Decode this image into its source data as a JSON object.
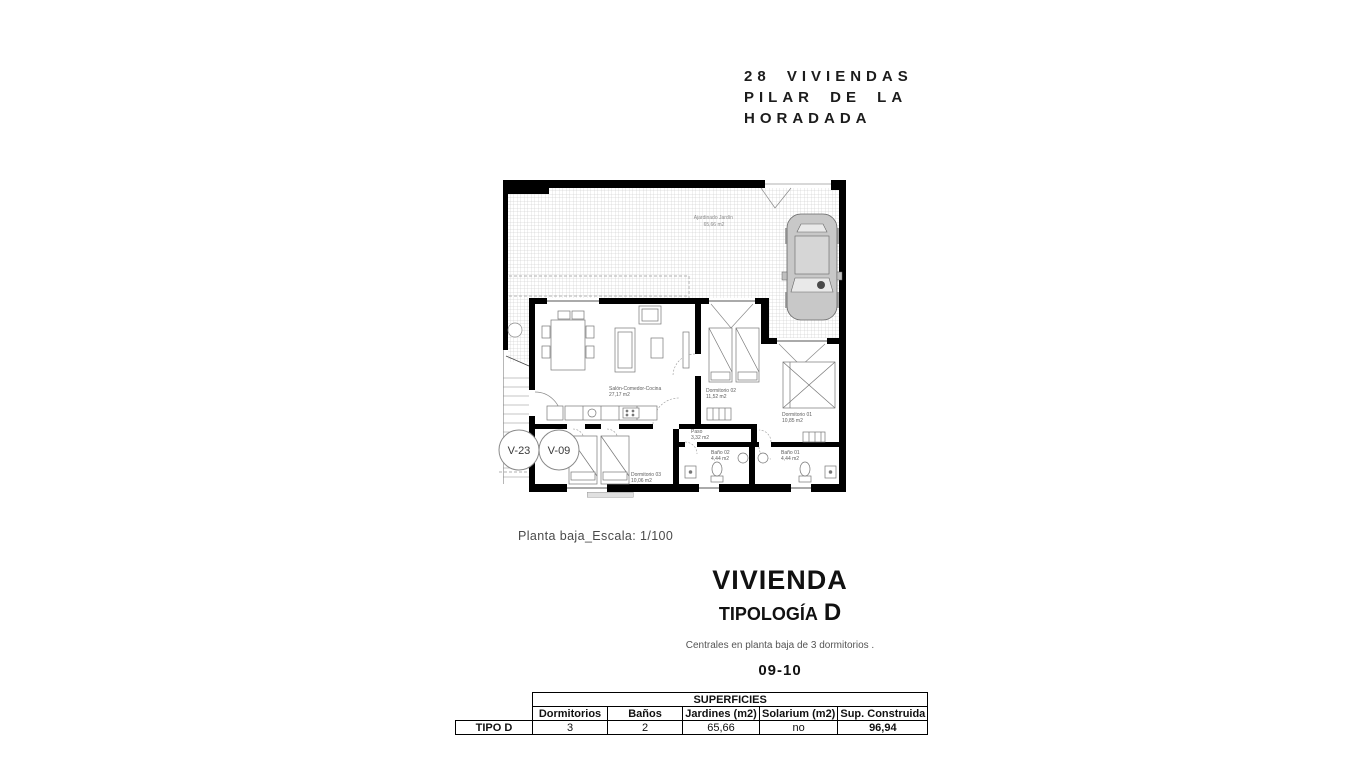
{
  "header": {
    "lines": [
      "28 VIVIENDAS",
      "PILAR DE LA",
      "HORADADA"
    ]
  },
  "plan": {
    "scale_note": "Planta baja_Escala: 1/100",
    "garden": {
      "name": "Ajardinado Jardín",
      "area": "65,66 m2"
    },
    "rooms": [
      {
        "name": "Salón-Comedor-Cocina",
        "area": "27,17 m2"
      },
      {
        "name": "Dormitorio 02",
        "area": "11,52 m2"
      },
      {
        "name": "Dormitorio 01",
        "area": "10,85 m2"
      },
      {
        "name": "Paso",
        "area": "3,32 m2"
      },
      {
        "name": "Baño 02",
        "area": "4,44 m2"
      },
      {
        "name": "Baño 01",
        "area": "4,44 m2"
      },
      {
        "name": "Dormitorio 03",
        "area": "10,06 m2"
      }
    ],
    "unit_tags": [
      "V-23",
      "V-09"
    ]
  },
  "title_block": {
    "title": "VIVIENDA",
    "subtitle": "TIPOLOGÍA",
    "type_letter": "D",
    "description": "Centrales en planta baja de 3 dormitorios .",
    "units": "09-10"
  },
  "table": {
    "title": "SUPERFICIES",
    "row_label": "TIPO D",
    "columns": [
      "Dormitorios",
      "Baños",
      "Jardines (m2)",
      "Solarium (m2)",
      "Sup. Construida"
    ],
    "values": [
      "3",
      "2",
      "65,66",
      "no",
      "96,94"
    ]
  },
  "colors": {
    "wall": "#000000",
    "line": "#666666",
    "grid": "#c3c3c3",
    "muted_text": "#555555"
  }
}
